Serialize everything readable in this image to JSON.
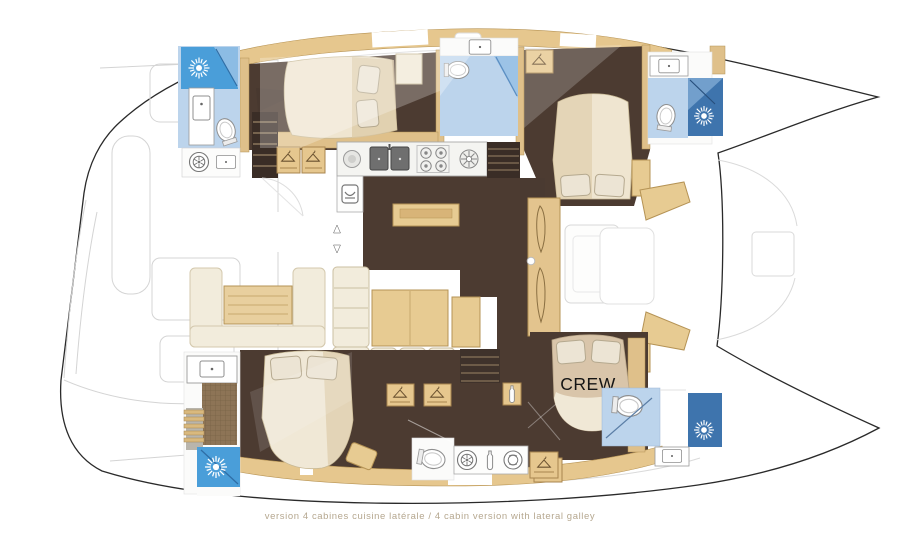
{
  "diagram": {
    "type": "catamaran interior floor plan",
    "caption": "version 4 cabines cuisine latérale / 4 cabin version with lateral galley",
    "crew_label": "CREW",
    "rooms": [
      "aft cockpit",
      "salon",
      "lateral galley",
      "port aft bathroom",
      "port aft cabin",
      "port mid bathroom",
      "port forward cabin",
      "port forward bathroom",
      "starboard aft bathroom",
      "starboard aft cabin",
      "starboard mid bathroom",
      "crew cabin",
      "crew bathroom",
      "foredeck"
    ],
    "icons": [
      "shower-sun",
      "toilet",
      "washbasin",
      "double-sink",
      "stove-burners",
      "hotplate",
      "washing-machine",
      "refrigerator",
      "wardrobe-hanger",
      "bottle-rack",
      "companionway-stairs",
      "up-down-arrows"
    ],
    "colors": {
      "hull_outline": "#2a2a2a",
      "floor_dark_brown": "#4c3b31",
      "floor_darker": "#3a2d26",
      "furniture_beige": "#e6c78e",
      "furniture_beige_edge": "#b59355",
      "upholstery_cream": "#f1e9d8",
      "bed_shade_tan": "#d9c5aa",
      "shower_blue": "#4a9ed9",
      "shower_blue_dark": "#3e74ad",
      "bath_floor_blue": "#bcd4ec",
      "tile_brown": "#8d7456",
      "fixture_white": "#ffffff",
      "deck_faint_grey": "#d6d6d6",
      "caption_text": "#b5a78f",
      "crew_text": "#151515"
    }
  }
}
